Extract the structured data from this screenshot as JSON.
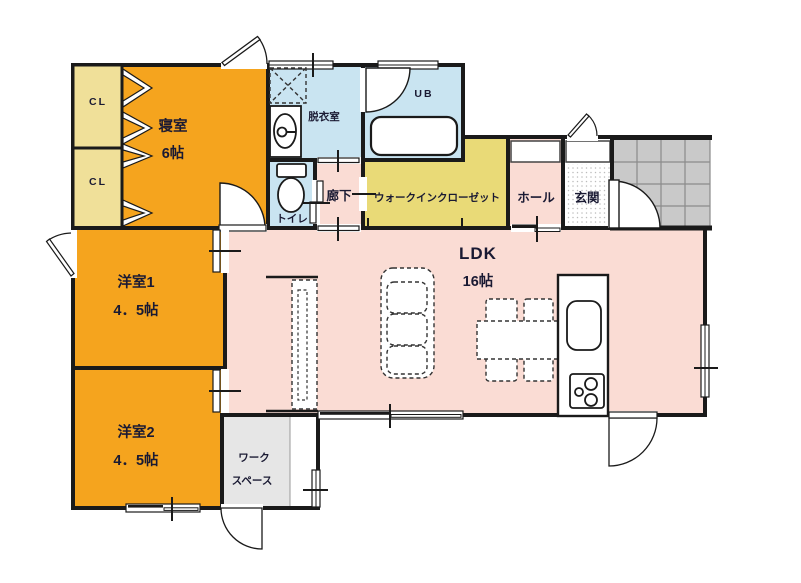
{
  "floor_plan": {
    "kind": "japanese-residential-madori",
    "rooms": {
      "bedroom": {
        "label": "寝室",
        "size": "6帖"
      },
      "closet1": {
        "label": "CL"
      },
      "closet2": {
        "label": "CL"
      },
      "dressing_room": {
        "label": "脱衣室"
      },
      "unit_bath": {
        "label": "UB"
      },
      "toilet": {
        "label": "トイレ"
      },
      "hallway": {
        "label": "廊下"
      },
      "walk_in_closet": {
        "label": "ウォークインクローゼット"
      },
      "hall": {
        "label": "ホール"
      },
      "entrance": {
        "label": "玄関"
      },
      "ldk": {
        "label": "LDK",
        "size": "16帖"
      },
      "western_room_1": {
        "label": "洋室1",
        "size": "4．5帖"
      },
      "western_room_2": {
        "label": "洋室2",
        "size": "4．5帖"
      },
      "workspace": {
        "label_line1": "ワーク",
        "label_line2": "スペース"
      }
    },
    "colors": {
      "room_orange": "#F5A41E",
      "closet_yellow": "#F0E099",
      "wic_yellow": "#E9DA77",
      "wet_blue": "#C9E4F1",
      "living_pink": "#FADCD4",
      "porch_tile_gray": "#C9C9C9",
      "workspace_gray": "#E6E6E6",
      "wall_black": "#1A1A1A"
    }
  }
}
